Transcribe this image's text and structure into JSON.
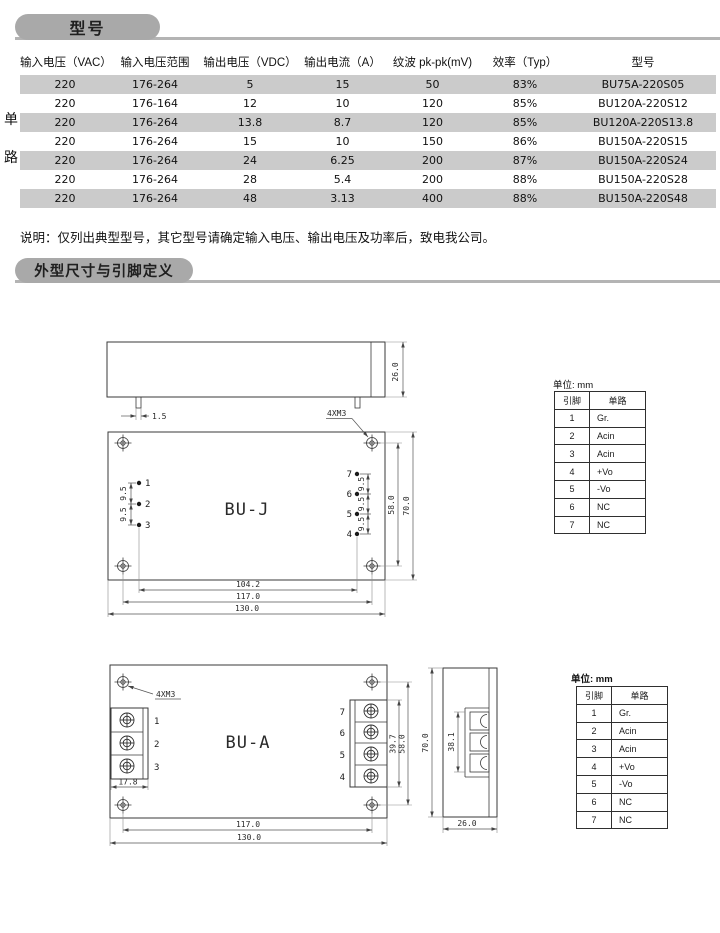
{
  "page": {
    "section1_title": "型号",
    "section2_title": "外型尺寸与引脚定义",
    "note": "说明：仅列出典型型号，其它型号请确定输入电压、输出电压及功率后，致电我公司。",
    "row_group": {
      "char1": "单",
      "char2": "路"
    }
  },
  "spec_table": {
    "headers": [
      "输入电压（VAC）",
      "输入电压范围",
      "输出电压（VDC）",
      "输出电流（A）",
      "纹波 pk-pk(mV)",
      "效率（Typ）",
      "型号"
    ],
    "rows": [
      [
        "220",
        "176-264",
        "5",
        "15",
        "50",
        "83%",
        "BU75A-220S05"
      ],
      [
        "220",
        "176-164",
        "12",
        "10",
        "120",
        "85%",
        "BU120A-220S12"
      ],
      [
        "220",
        "176-264",
        "13.8",
        "8.7",
        "120",
        "85%",
        "BU120A-220S13.8"
      ],
      [
        "220",
        "176-264",
        "15",
        "10",
        "150",
        "86%",
        "BU150A-220S15"
      ],
      [
        "220",
        "176-264",
        "24",
        "6.25",
        "200",
        "87%",
        "BU150A-220S24"
      ],
      [
        "220",
        "176-264",
        "28",
        "5.4",
        "200",
        "88%",
        "BU150A-220S28"
      ],
      [
        "220",
        "176-264",
        "48",
        "3.13",
        "400",
        "88%",
        "BU150A-220S48"
      ]
    ]
  },
  "drawings": {
    "bu_j": {
      "label": "BU-J",
      "screw_label": "4XM3",
      "dim_height": "26.0",
      "dim_pin": "1.5",
      "dim_pitch": "9.5",
      "dim_58": "58.0",
      "dim_70": "70.0",
      "dim_104": "104.2",
      "dim_117": "117.0",
      "dim_130": "130.0",
      "pins_left": [
        "1",
        "2",
        "3"
      ],
      "pins_right": [
        "7",
        "6",
        "5",
        "4"
      ]
    },
    "bu_a": {
      "label": "BU-A",
      "screw_label": "4XM3",
      "dim_178": "17.8",
      "dim_397": "39.7",
      "dim_58": "58.0",
      "dim_70": "70.0",
      "dim_381": "38.1",
      "dim_26": "26.0",
      "dim_117": "117.0",
      "dim_130": "130.0",
      "pins_left": [
        "1",
        "2",
        "3"
      ],
      "pins_right": [
        "7",
        "6",
        "5",
        "4"
      ]
    }
  },
  "pin_table": {
    "unit_label": "单位: mm",
    "headers": [
      "引脚",
      "单路"
    ],
    "rows": [
      [
        "1",
        "Gr."
      ],
      [
        "2",
        "Acin"
      ],
      [
        "3",
        "Acin"
      ],
      [
        "4",
        "+Vo"
      ],
      [
        "5",
        "-Vo"
      ],
      [
        "6",
        "NC"
      ],
      [
        "7",
        "NC"
      ]
    ]
  },
  "colors": {
    "pill": "#a9a9a9",
    "row_alt": "#cbcbcb",
    "line": "#3a3a3a"
  }
}
